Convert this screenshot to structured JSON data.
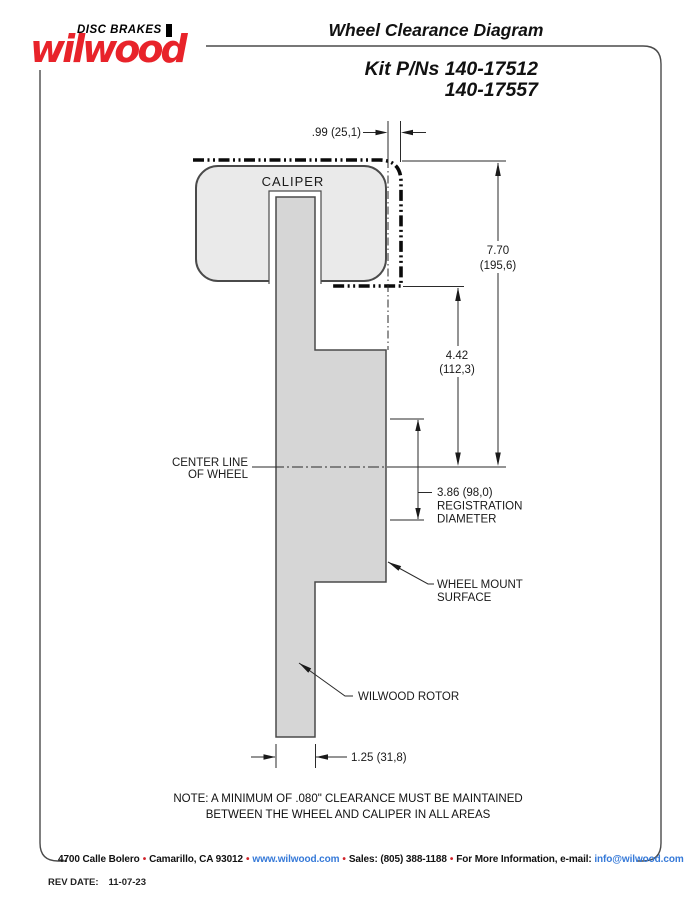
{
  "header": {
    "logo": {
      "tagline": "DISC BRAKES",
      "brand": "wilwood"
    },
    "title": "Wheel Clearance Diagram",
    "kit_line1": "Kit P/Ns 140-17512",
    "kit_line2": "140-17557"
  },
  "labels": {
    "caliper": "CALIPER",
    "centerline1": "CENTER LINE",
    "centerline2": "OF WHEEL",
    "wheel_mount1": "WHEEL MOUNT",
    "wheel_mount2": "SURFACE",
    "rotor": "WILWOOD ROTOR"
  },
  "dims": {
    "overhang": ".99 (25,1)",
    "height_in": "7.70",
    "height_mm": "(195,6)",
    "mount_in": "4.42",
    "mount_mm": "(112,3)",
    "reg_dim": "3.86 (98,0)",
    "reg_l2": "REGISTRATION",
    "reg_l3": "DIAMETER",
    "rotor_width": "1.25 (31,8)"
  },
  "note": {
    "line1": "NOTE: A MINIMUM OF .080\" CLEARANCE MUST BE MAINTAINED",
    "line2": "BETWEEN THE WHEEL AND CALIPER IN ALL AREAS"
  },
  "footer": {
    "address": "4700 Calle Bolero",
    "city": "Camarillo, CA 93012",
    "website": "www.wilwood.com",
    "sales": "Sales: (805) 388-1188",
    "more_info": "For More Information, e-mail:",
    "email": "info@wilwood.com",
    "separator": "•",
    "rev_label": "REV DATE:",
    "rev_date": "11-07-23"
  },
  "colors": {
    "brand_red": "#e8232a",
    "link_blue": "#3579d8",
    "caliper_fill": "#eaeaea",
    "rotor_fill": "#d6d6d6",
    "envelope_black": "#0a0a0a"
  }
}
